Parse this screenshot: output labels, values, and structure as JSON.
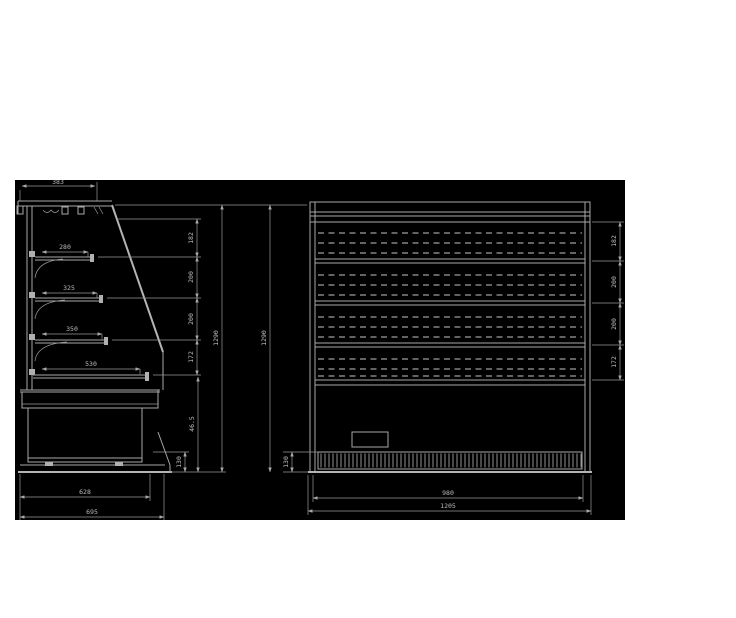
{
  "drawing": {
    "background_color": "#000000",
    "line_color": "#a8a8a8",
    "side_view": {
      "top_depth": "383",
      "shelf_depths": [
        "280",
        "325",
        "350",
        "530"
      ],
      "shelf_spacings": [
        "182",
        "200",
        "200",
        "172"
      ],
      "lower_section_height": "46.5",
      "total_height": "1290",
      "plinth_height": "130",
      "base_depth": "628",
      "overall_depth": "695"
    },
    "front_view": {
      "total_height": "1290",
      "shelf_spacings": [
        "182",
        "200",
        "200",
        "172"
      ],
      "grille_height": "130",
      "inner_width": "980",
      "overall_width": "1205"
    }
  }
}
